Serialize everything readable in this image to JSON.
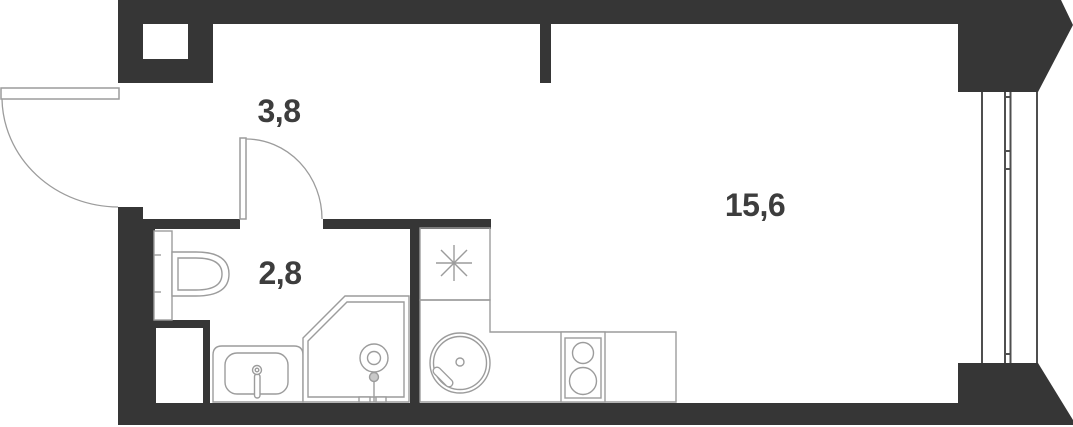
{
  "colors": {
    "wall": "#363636",
    "fixture_line": "#9c9c9c",
    "window_line": "#4f4f4f",
    "label_text": "#3d3d3d",
    "background": "#ffffff"
  },
  "rooms": [
    {
      "id": "hallway",
      "area_label": "3,8"
    },
    {
      "id": "bathroom",
      "area_label": "2,8"
    },
    {
      "id": "living-room",
      "area_label": "15,6"
    }
  ],
  "fixtures": [
    "entry-door",
    "bathroom-door",
    "ventilation-shaft",
    "wall-niche",
    "toilet",
    "washbasin",
    "shower",
    "refrigerator-symbol",
    "kitchen-counter",
    "kitchen-sink",
    "cooktop",
    "window"
  ]
}
